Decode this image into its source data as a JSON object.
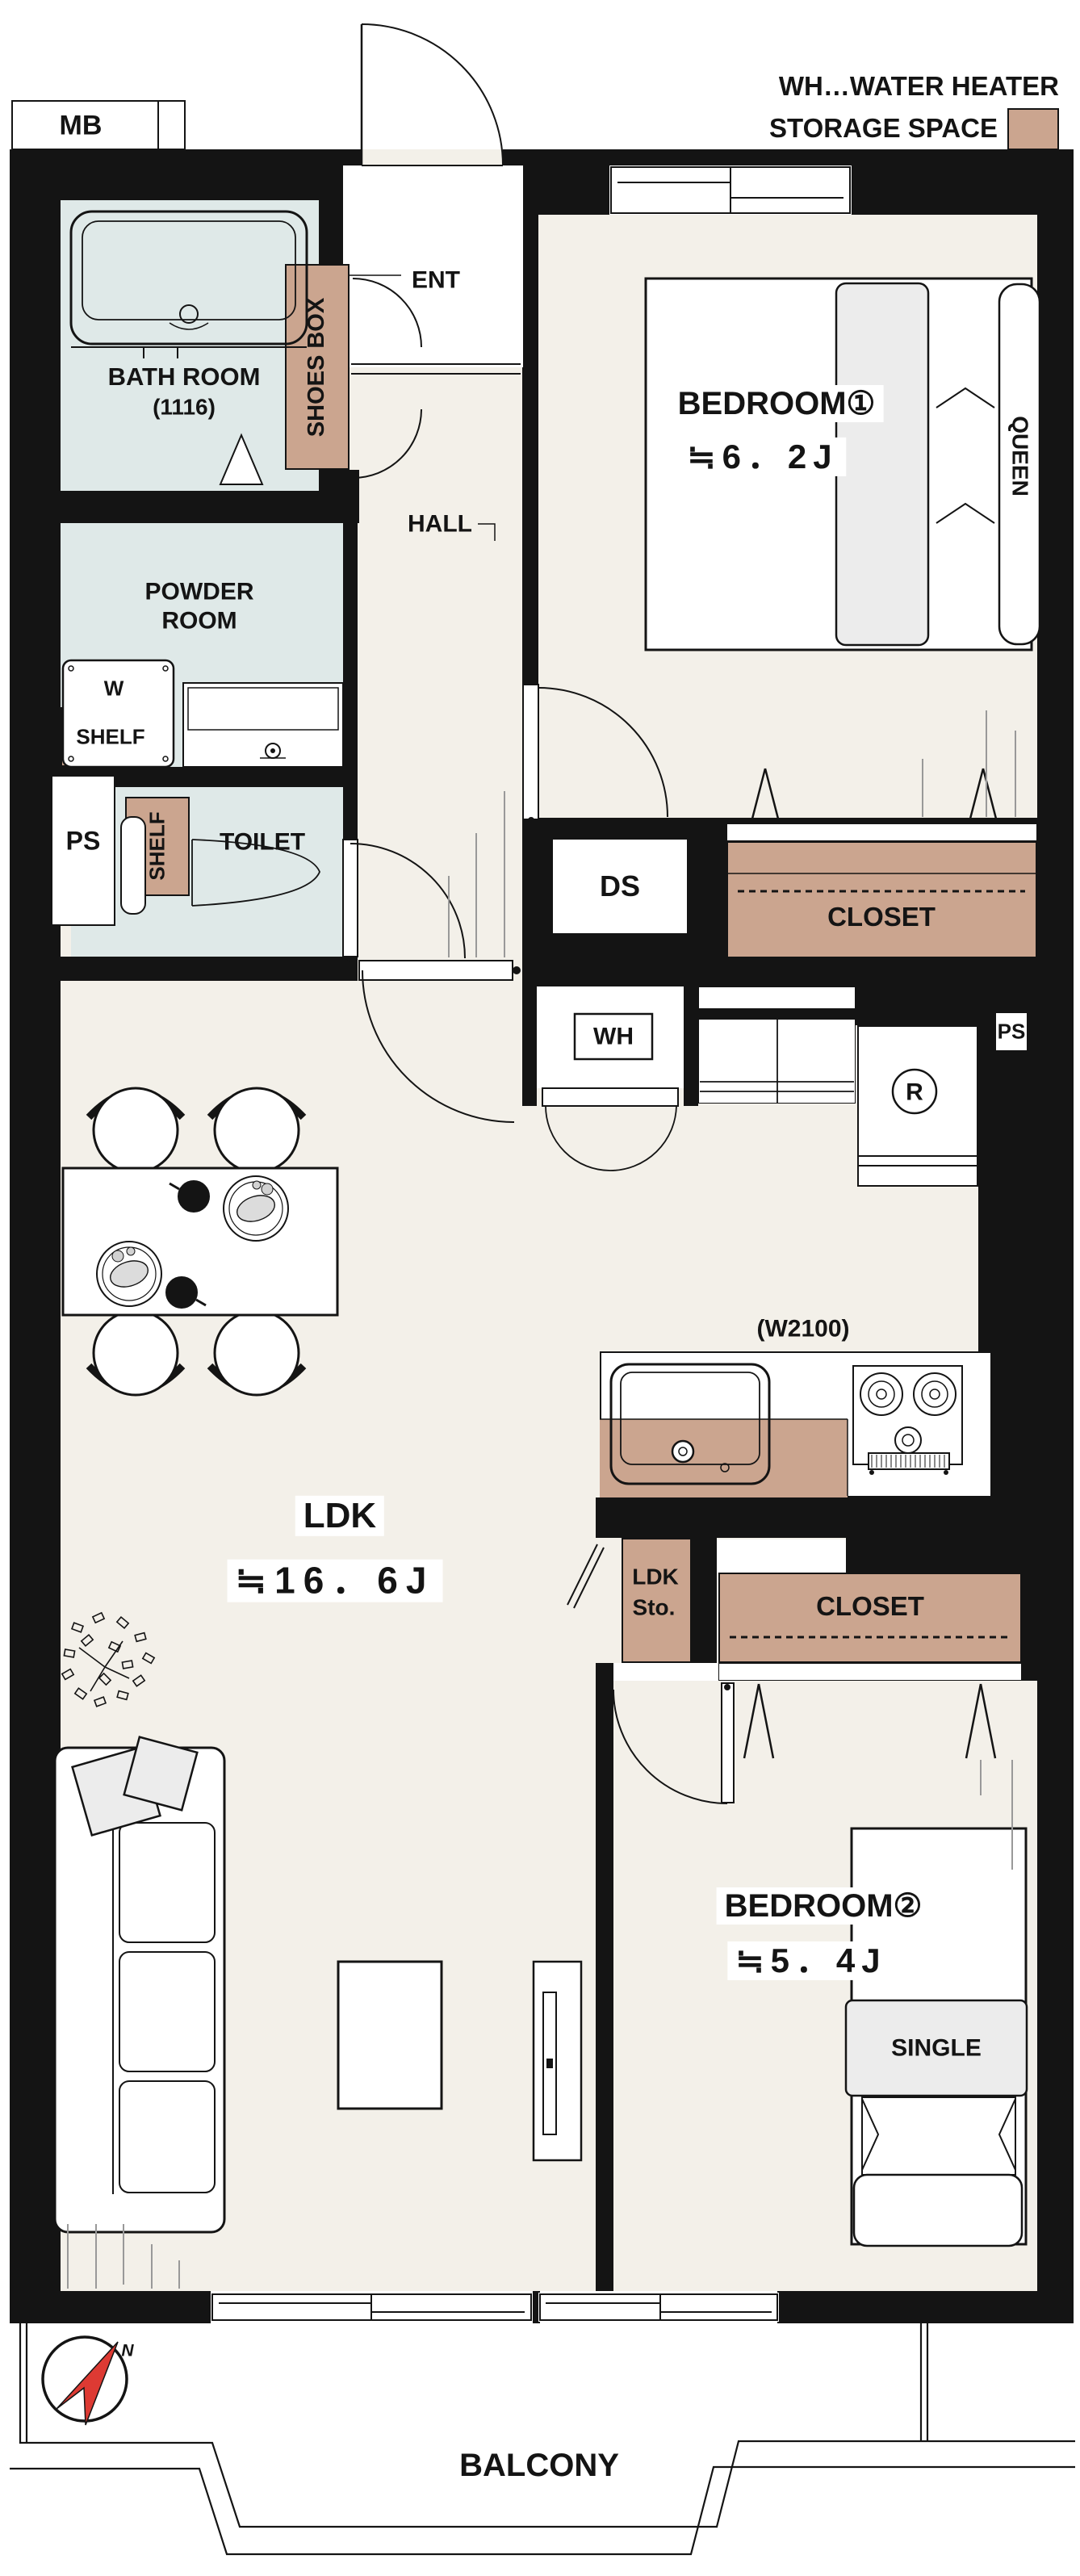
{
  "legend": {
    "water_heater": "WH…WATER HEATER",
    "storage": "STORAGE SPACE",
    "storage_swatch_color": "#cba58f"
  },
  "labels": {
    "mb": "MB",
    "bath": "BATH ROOM",
    "bath_size": "(1116)",
    "shoes_box": "SHOES BOX",
    "ent": "ENT",
    "hall": "HALL",
    "powder_line1": "POWDER",
    "powder_line2": "ROOM",
    "washer": "W",
    "shelf_powder": "SHELF",
    "ps_left": "PS",
    "shelf_toilet": "SHELF",
    "toilet": "TOILET",
    "bedroom1": "BEDROOM①",
    "bedroom1_size": "≒6．2J",
    "queen": "QUEEN",
    "closet1": "CLOSET",
    "ds": "DS",
    "wh": "WH",
    "ps_right": "PS",
    "fridge": "R",
    "kitchen_width": "(W2100)",
    "ldk": "LDK",
    "ldk_size": "≒16．6J",
    "ldk_sto_line1": "LDK",
    "ldk_sto_line2": "Sto.",
    "closet2": "CLOSET",
    "bedroom2": "BEDROOM②",
    "bedroom2_size": "≒5．4J",
    "single": "SINGLE",
    "balcony": "BALCONY",
    "compass_north": "N"
  },
  "colors": {
    "wall": "#141414",
    "floor_cream": "#f3f0e9",
    "wet_area_blue": "#dfe9e8",
    "storage_tan": "#cba58f",
    "furniture_gray": "#ececec",
    "compass_red": "#dd3a33"
  }
}
